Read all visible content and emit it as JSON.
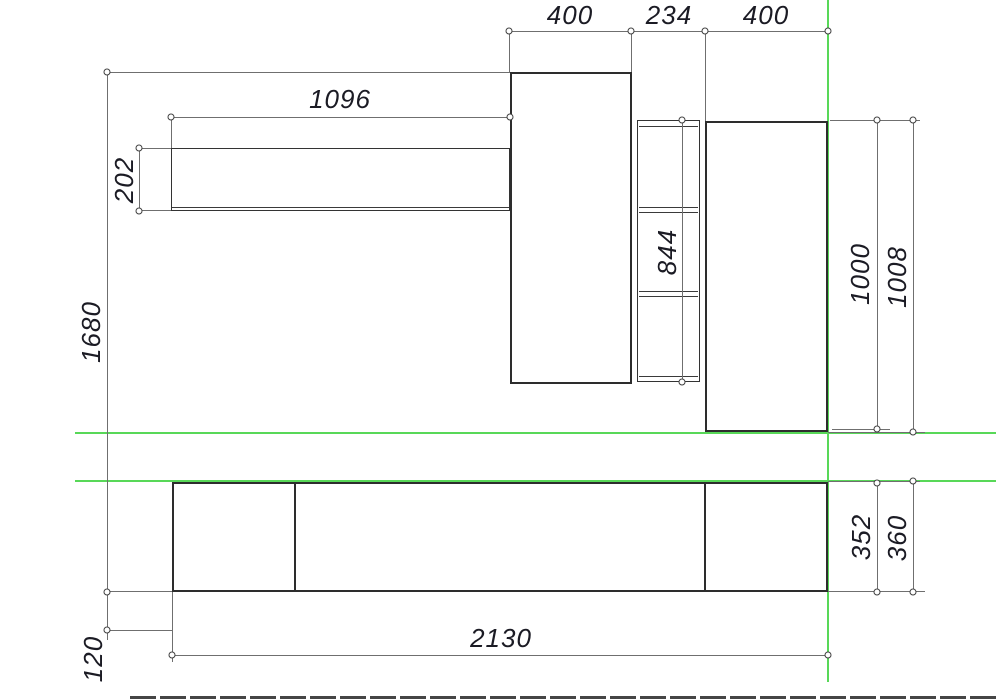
{
  "drawing": {
    "kind": "furniture-wall-unit-elevation",
    "units": "mm",
    "colors": {
      "outline": "#2d2d2d",
      "inner_line": "#3a3a3a",
      "dimension_line": "#6f6f6f",
      "construction_line": "#58d858",
      "text": "#1b1b24",
      "background": "#ffffff"
    },
    "dims": {
      "cabinet_left_width": "400",
      "shelf_column_width": "234",
      "cabinet_right_width": "400",
      "wall_shelf_length": "1096",
      "wall_shelf_height": "202",
      "overall_height": "1680",
      "shelf_column_height": "844",
      "right_cabinet_height": "1000",
      "right_cabinet_height_overall": "1008",
      "base_unit_height": "352",
      "base_unit_height_overall": "360",
      "base_unit_length": "2130",
      "base_clearance_height": "120"
    }
  }
}
